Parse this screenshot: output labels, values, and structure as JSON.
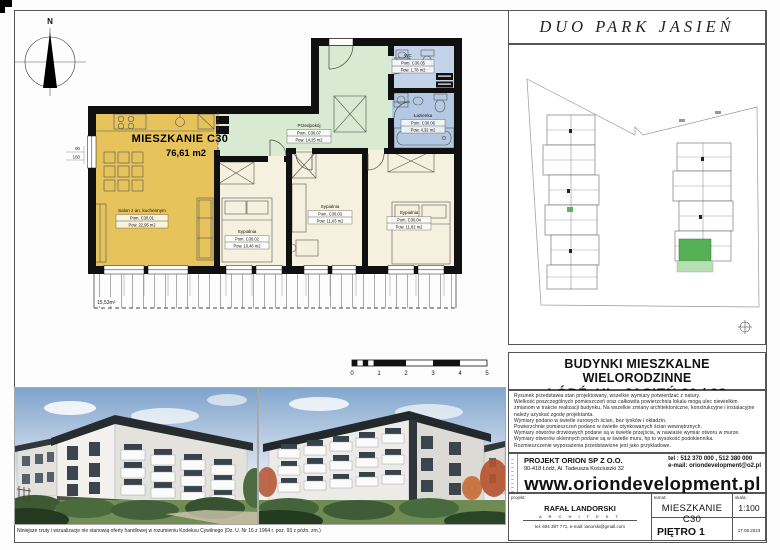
{
  "title": "DUO  PARK  JASIEŃ",
  "plan": {
    "apartment": {
      "label": "MIESZKANIE C30",
      "area": "76,61 m2"
    },
    "compass": "N",
    "rooms": [
      {
        "name": "Salon z an. kuchennym",
        "no": "Pom. C30.01",
        "area": "Pow. 22,95 m2"
      },
      {
        "name": "Sypialnia",
        "no": "Pom. C30.02",
        "area": "Pow. 10,46 m2"
      },
      {
        "name": "Sypialnia",
        "no": "Pom. C30.03",
        "area": "Pow. 11,03 m2"
      },
      {
        "name": "Sypialnia",
        "no": "Pom. C30.04",
        "area": "Pow. 11,82 m2"
      },
      {
        "name": "Przedpokój",
        "no": "Pom. C30.07",
        "area": "Pow. 14,25 m2"
      },
      {
        "name": "WC",
        "no": "Pom. C30.05",
        "area": "Pow. 1,78 m2"
      },
      {
        "name": "Łazienka",
        "no": "Pom. C30.06",
        "area": "Pow. 4,32 m2"
      }
    ],
    "balcony_area": "15,53m²",
    "window_dim": {
      "width": "90",
      "height": "160"
    },
    "scalebar": [
      "0",
      "1",
      "2",
      "3",
      "4",
      "5"
    ]
  },
  "right_panel": {
    "building_header": {
      "line1": "BUDYNKI MIESZKALNE WIELORODZINNE",
      "line2": "ŁÓDŹ, UL. JASIEŃ 20 / 28"
    },
    "notes": [
      "Rysunek przedstawia stan projektowany, wszelkie wymiary potwierdzać z natury.",
      "Wielkość poszczególnych pomieszczeń oraz całkowita powierzchnia lokalu mogą ulec niewielkim zmianom w trakcie realizacji budynku. Na wszelkie zmiany architektoniczne, konstrukcyjne i instalacyjne należy uzyskać zgodę projektanta.",
      "Wymiary podano w świetle surowych ścian, bez tynków i okładzin.",
      "Powierzchnie pomieszczeń podano w świetle otynkowanych ścian wewnętrznych.",
      "Wymiary otworów drzwiowych podane są w świetle przejścia, w nawiasie wymiar otworu w murze.",
      "Wymiary otworów okiennych podane są w świetle muru, hp to wysokość podokiennika.",
      "Rozmieszczenie wyposażenia przedstawione jest jako przykładowe."
    ],
    "company": {
      "name": "PROJEKT ORION SP Z O.O.",
      "address": "90-418 Łódź, Al. Tadeusza Kościuszki 32",
      "phone": "tel : 512 370 000 , 512 380 000",
      "email": "e-mail: oriondevelopment@o2.pl",
      "website": "www.oriondevelopment.pl"
    },
    "titleblock": {
      "col1_label": "projekt:",
      "col2_label": "temat:",
      "col3_label": "skala:",
      "architect": "RAFAŁ LANDORSKI",
      "architect_title": "A R C H I T E K T",
      "architect_contact": "tel. 604 397 771,    e-mail: lanorski@gmail.com",
      "drawing": "MIESZKANIE  C30",
      "floor": "PIĘTRO 1",
      "scale": "1:100",
      "date": "17.08.2023"
    }
  },
  "footer": {
    "disclaimer": "Niniejsze rzuty i wizualizacje nie stanowią oferty handlowej w rozumieniu Kodeksu Cywilnego (Dz. U. Nr 16 z 1964 r. poz. 93 z późn. zm.)"
  },
  "colors": {
    "salon": "#e7c35c",
    "hall": "#d9ead3",
    "wc": "#c3d4e9",
    "bath": "#b3c8e2",
    "bedroom": "#f6f0de",
    "site_highlight": "#55b055",
    "site_terrace": "#b9ddb2"
  }
}
